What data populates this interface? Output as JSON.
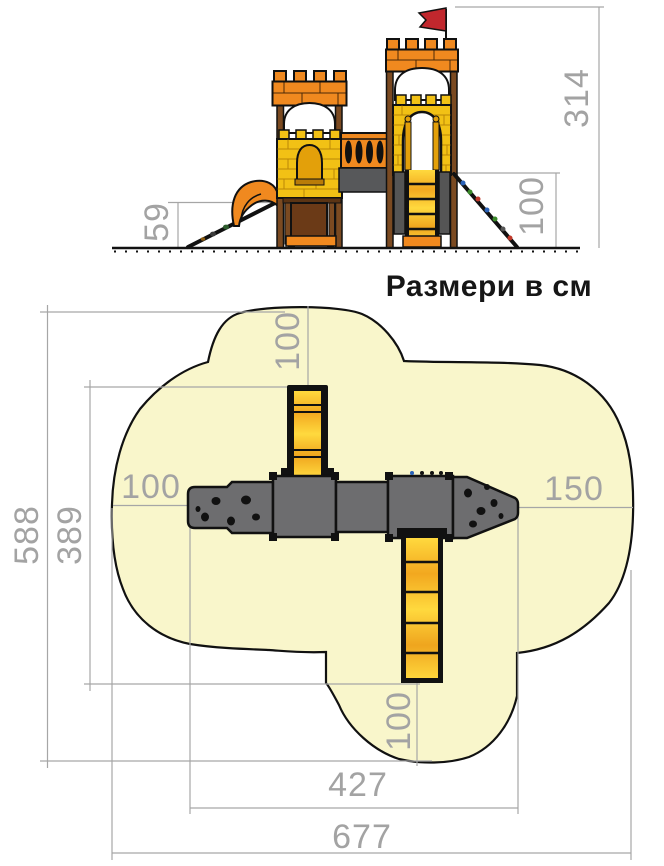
{
  "title": "Размери в см",
  "dimensions": {
    "elevation": {
      "total_height": "314",
      "climber_height": "100",
      "slide_height": "59"
    },
    "plan": {
      "ladder_top": "100",
      "left_clearance": "100",
      "right_clearance": "150",
      "area_depth": "588",
      "equipment_depth": "389",
      "ladder_bottom": "100",
      "equipment_width": "427",
      "area_width": "677"
    }
  },
  "colors": {
    "background": "#ffffff",
    "safety_area_fill": "#f9f6cb",
    "outline": "#111111",
    "structure_gray": "#6d6d6f",
    "beam_gray": "#57585a",
    "castle_orange": "#f0891f",
    "brick_yellow": "#f2c115",
    "window_amber": "#e3a00a",
    "wood_brown": "#7b4a21",
    "panel_brown": "#6b3a17",
    "flag_red": "#c1272d",
    "ladder_yellow": "#ffd83c",
    "dimension_gray": "#a3a3a3"
  }
}
